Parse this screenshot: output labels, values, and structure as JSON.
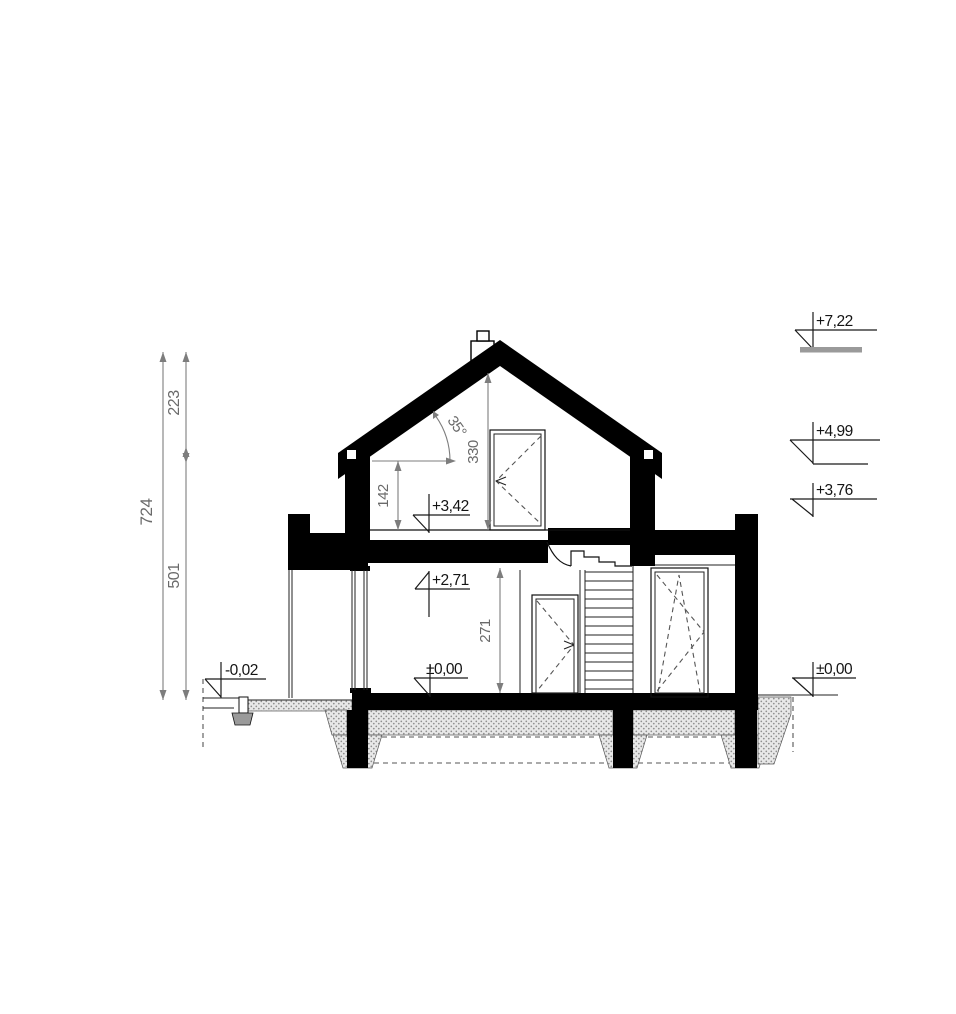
{
  "drawing_title": "House cross-section",
  "left_dimensions": {
    "total": "724",
    "upper": "223",
    "lower": "501"
  },
  "internal_dimensions": {
    "knee_wall": "142",
    "attic": "330",
    "ground_floor": "271",
    "roof_pitch": "35°"
  },
  "elevations": {
    "ridge": "+7,22",
    "eaves": "+4,99",
    "flat_roof": "+3,76",
    "attic_floor": "+3,42",
    "ceiling": "+2,71",
    "floor_interior": "±0,00",
    "ground_exterior": "±0,00",
    "terrace": "-0,02"
  },
  "colors": {
    "section": "#000000",
    "dimensions": "#7d7d7d",
    "hatch_dot": "#8f8f8f",
    "hatch_bg": "#e8e8e8"
  }
}
